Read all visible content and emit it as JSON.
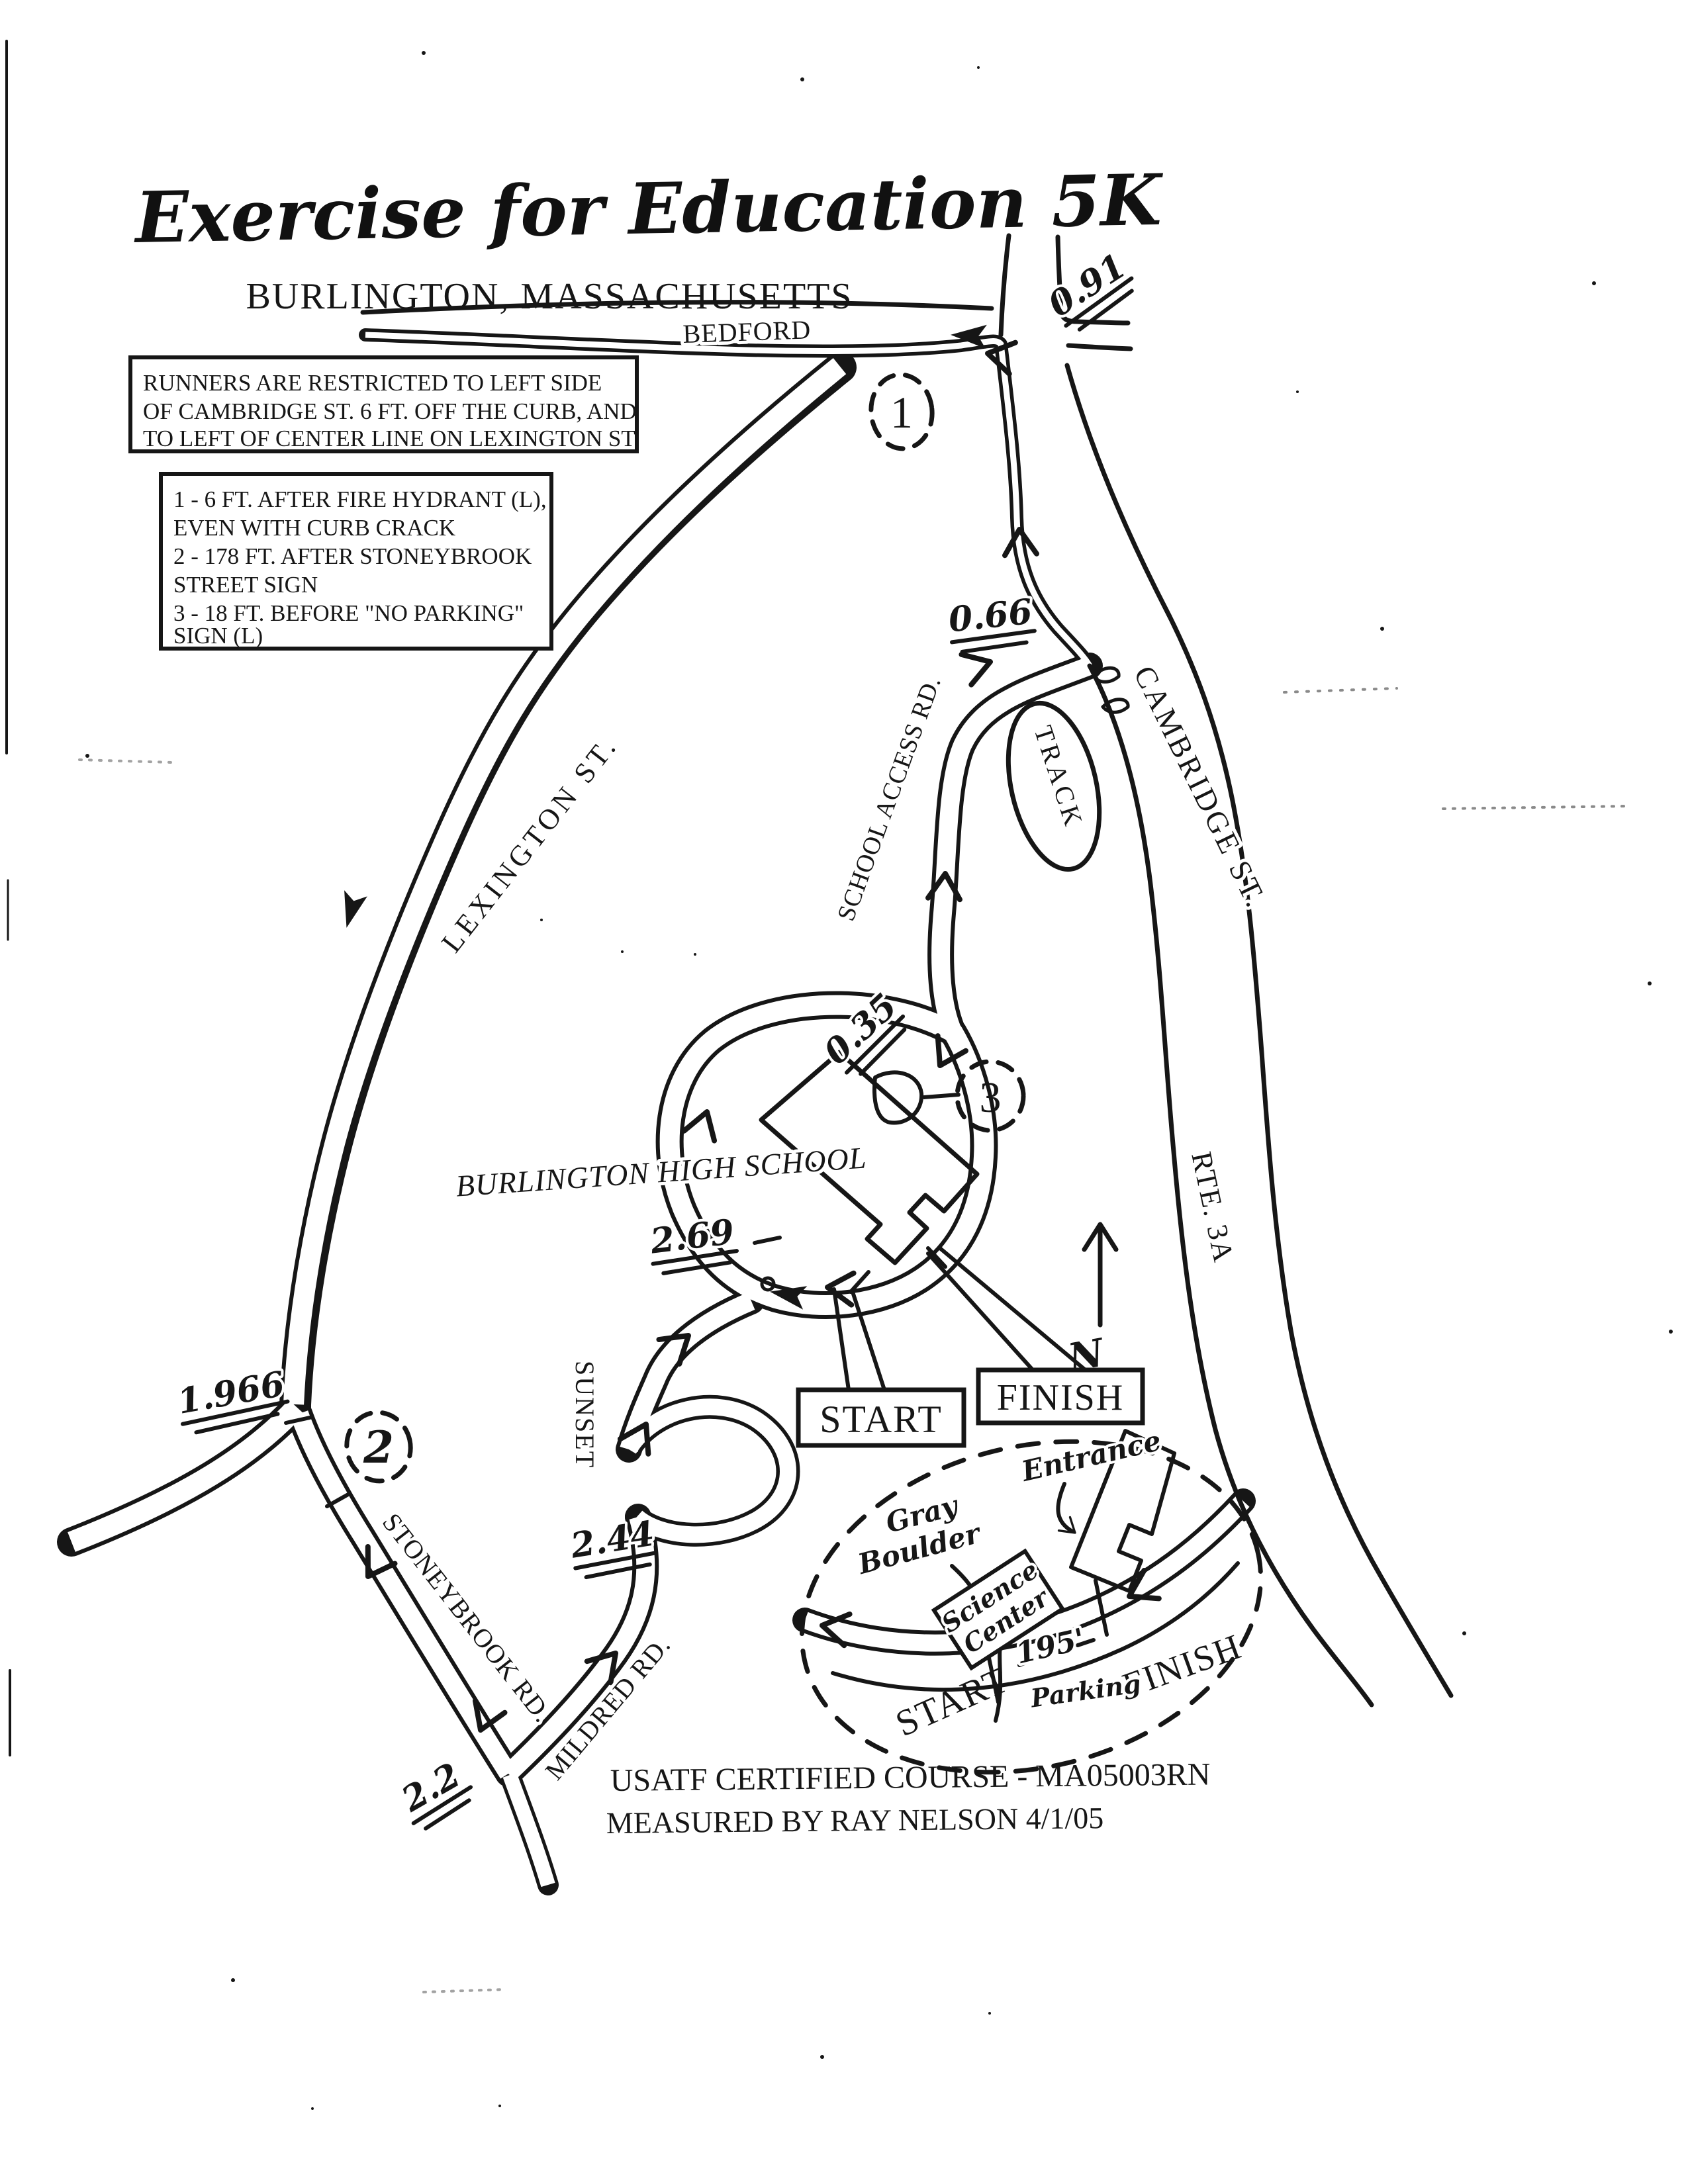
{
  "title": "Exercise for Education 5K",
  "subtitle": "BURLINGTON, MASSACHUSETTS",
  "boxes": {
    "restriction": [
      "RUNNERS ARE RESTRICTED TO LEFT SIDE",
      "OF CAMBRIDGE ST. 6 FT. OFF THE CURB, AND",
      "TO LEFT OF CENTER LINE ON LEXINGTON ST."
    ],
    "landmarks": [
      "1 - 6 FT. AFTER FIRE HYDRANT (L),",
      "EVEN WITH CURB CRACK",
      "2 - 178 FT. AFTER STONEYBROOK",
      "STREET SIGN",
      "3 - 18 FT. BEFORE \"NO PARKING\"",
      "SIGN (L)"
    ]
  },
  "roads": {
    "bedford": "BEDFORD",
    "lexington": "LEXINGTON ST.",
    "cambridge": "CAMBRIDGE ST.",
    "school_access": "SCHOOL ACCESS RD.",
    "rte_3a": "RTE. 3A",
    "sunset": "SUNSET",
    "stoneybrook": "STONEYBROOK RD.",
    "mildred": "MILDRED RD."
  },
  "labels": {
    "track": "TRACK",
    "school": "BURLINGTON HIGH SCHOOL",
    "start": "START",
    "finish": "FINISH",
    "north": "N"
  },
  "mile_markers": {
    "bedford": "0.91",
    "school_access": "0.66",
    "school_loop": "0.35",
    "sunset": "2.69",
    "lexington_fork": "1.966",
    "sunset_mildred": "2.44",
    "stoneybrook_end": "2.2"
  },
  "checkpoints": {
    "c1": "1",
    "c2": "2",
    "c3": "3"
  },
  "inset": {
    "entrance": "Entrance",
    "gray": "Gray",
    "boulder": "Boulder",
    "science": "Science",
    "center": "Center",
    "distance": "195'",
    "finish": "FINISH",
    "start": "START",
    "parking": "Parking"
  },
  "footer": {
    "line1": "USATF CERTIFIED COURSE - MA05003RN",
    "line2": "MEASURED BY RAY NELSON 4/1/05"
  },
  "ink_color": "#161616"
}
